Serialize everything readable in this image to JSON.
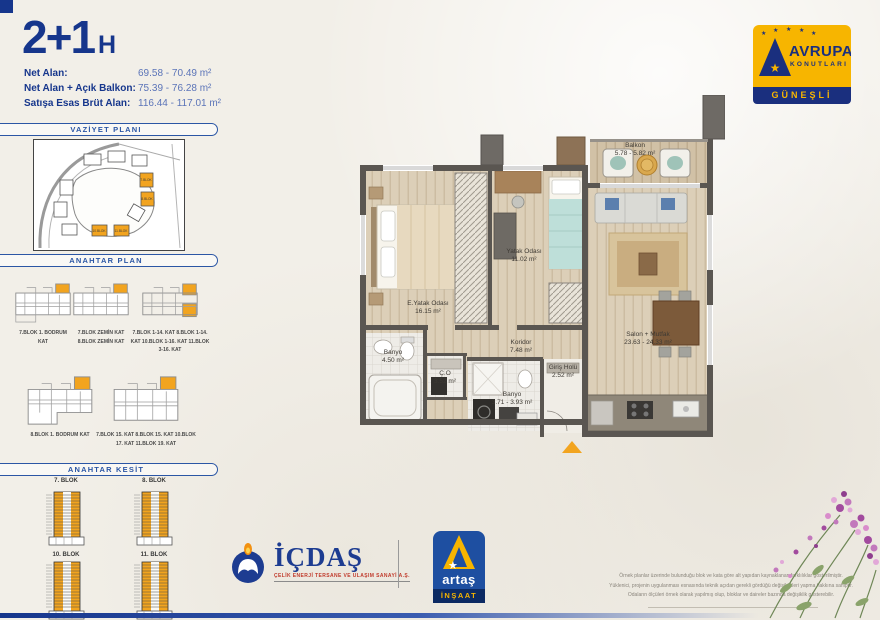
{
  "header": {
    "title": "2+1",
    "title_suffix": "H",
    "areas": [
      {
        "label": "Net Alan:",
        "value": "69.58 - 70.49 m²"
      },
      {
        "label": "Net Alan + Açık Balkon:",
        "value": "75.39 - 76.28 m²"
      },
      {
        "label": "Satışa Esas Brüt Alan:",
        "value": "116.44 - 117.01 m²"
      }
    ]
  },
  "brand": {
    "name_line1": "AVRUPA",
    "name_line2": "KONUTLARI",
    "location": "GÜNEŞLİ",
    "colors": {
      "yellow": "#f7b500",
      "navy": "#1a2f7e"
    }
  },
  "sidebar": {
    "sections": [
      {
        "title": "VAZİYET PLANI"
      },
      {
        "title": "ANAHTAR PLAN"
      },
      {
        "title": "ANAHTAR KESİT"
      }
    ],
    "vaziyet_blocks": [
      "7.BLOK",
      "8.BLOK",
      "10.BLOK",
      "11.BLOK"
    ],
    "plan_keys": [
      {
        "caption": "7.BLOK\n1. BODRUM KAT"
      },
      {
        "caption": "7.BLOK ZEMİN KAT\n8.BLOK ZEMİN KAT"
      },
      {
        "caption": "7.BLOK 1-14. KAT\n8.BLOK 1-14. KAT\n10.BLOK 1-16. KAT\n11.BLOK 3-16. KAT"
      },
      {
        "caption": "8.BLOK\n1. BODRUM KAT"
      },
      {
        "caption": "7.BLOK 15. KAT\n8.BLOK 15. KAT\n10.BLOK 17. KAT\n11.BLOK 19. KAT"
      }
    ],
    "kesit_blocks": [
      {
        "label": "7. BLOK"
      },
      {
        "label": "8. BLOK"
      },
      {
        "label": "10. BLOK"
      },
      {
        "label": "11. BLOK"
      }
    ]
  },
  "floorplan": {
    "rooms": [
      {
        "id": "balkon",
        "label": "Balkon\n5.78 - 5.82 m²"
      },
      {
        "id": "salon",
        "label": "Salon + Mutfak\n23.63 - 24.33 m²"
      },
      {
        "id": "yatak",
        "label": "Yatak Odası\n11.02 m²"
      },
      {
        "id": "eyatak",
        "label": "E.Yatak Odası\n16.15 m²"
      },
      {
        "id": "koridor",
        "label": "Koridor\n7.48 m²"
      },
      {
        "id": "banyo1",
        "label": "Banyo\n4.50 m²"
      },
      {
        "id": "co",
        "label": "Ç.O\n3.52 m²"
      },
      {
        "id": "banyo2",
        "label": "Banyo\n3.71 - 3.93 m²"
      },
      {
        "id": "giris",
        "label": "Giriş Holü\n2.52 m²"
      }
    ],
    "accent_orange": "#f2a41f"
  },
  "footer": {
    "icdas_name": "İÇDAŞ",
    "icdas_tagline": "ÇELİK ENERJİ TERSANE VE ULAŞIM SANAYİ A.Ş.",
    "artas_name": "artaş",
    "artas_sub": "İNŞAAT",
    "disclaimer": "Örnek planlar üzerinde bulunduğu blok ve kata göre alt yapıdan kaynaklanan farklılıklar gösterilmiştir.\nYüklenici, projenin uygulanması esnasında teknik açıdan gerekli gördüğü değişiklikleri yapma hakkına sahiptir.\nOdaların ölçüleri örnek olarak yapılmış olup, bloklar ve daireler bazında değişiklik gösterebilir."
  }
}
